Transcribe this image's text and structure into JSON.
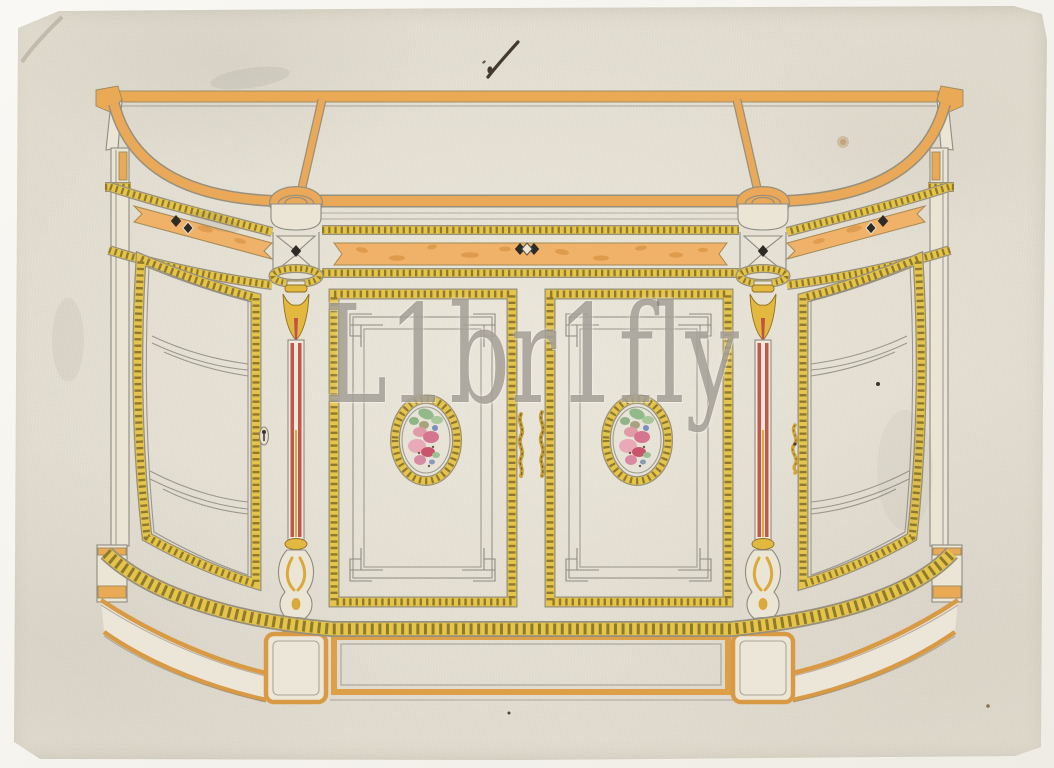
{
  "artwork": {
    "medium": "pen, pencil and watercolour design drawing on cream laid paper",
    "subject": "Design for a credenza sideboard with curved glass end doors, two panelled centre doors bearing oval floral porcelain medallions, red-striped turned columns, black inlay diamonds and gilt rope-twist mouldings on an orange-banded plinth"
  },
  "watermark": {
    "text": "L1br1fly"
  },
  "palette": {
    "scan_background": "#f7f5f0",
    "paper": "#dfdacd",
    "band_orange": "#eaa954",
    "burl_orange": "#f0b169",
    "rope_yellow": "#e5c44c",
    "rope_hatch_olive": "#6e5d1e",
    "column_red": "#c4574d",
    "gilt_gold": "#e2b93e",
    "inlay_black": "#2e2b26",
    "pencil_gray": "#8d8b82",
    "floral_pink": "#d4768f",
    "floral_green": "#92b989",
    "floral_blue": "#7a8fc0",
    "watermark_gray": "rgba(116,112,103,0.55)"
  }
}
